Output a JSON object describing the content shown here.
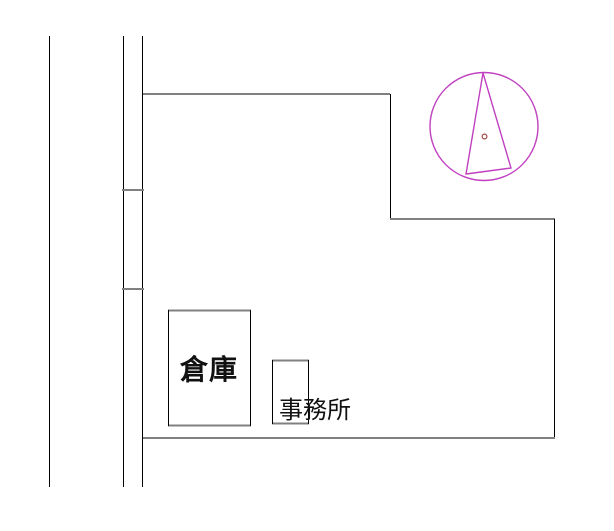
{
  "site_plan": {
    "labels": {
      "warehouse": "倉庫",
      "office": "事務所"
    },
    "colors": {
      "boundary_gray": "#808080",
      "line_black": "#000000",
      "north_symbol": "#c040c0",
      "center_dot": "#a04848",
      "label_text": "#111111"
    }
  }
}
